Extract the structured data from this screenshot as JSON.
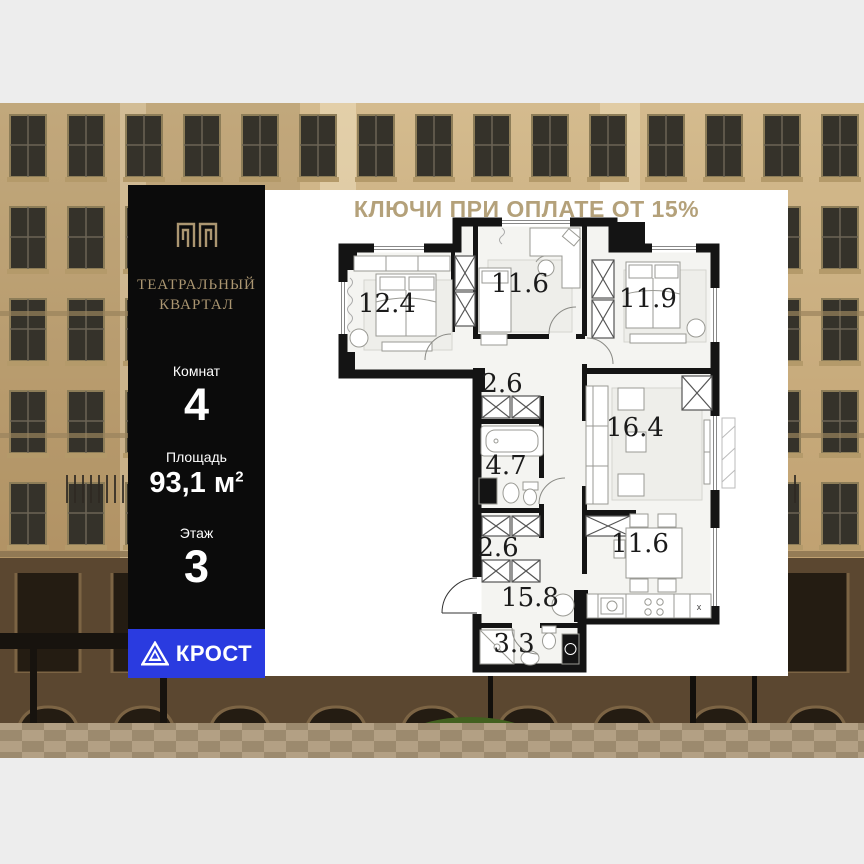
{
  "promo_banner": {
    "text": "КЛЮЧИ ПРИ ОПЛАТЕ ОТ 15%"
  },
  "info_panel": {
    "brand": {
      "line1": "ТЕАТРАЛЬНЫЙ",
      "line2": "КВАРТАЛ"
    },
    "stats": [
      {
        "label": "Комнат",
        "value": "4"
      },
      {
        "label": "Площадь",
        "value": "93,1 м",
        "sup": "2"
      },
      {
        "label": "Этаж",
        "value": "3"
      }
    ],
    "developer": {
      "name": "КРОСТ"
    }
  },
  "floorplan": {
    "room_labels": {
      "bedroom1": "12.4",
      "office": "11.6",
      "bedroom2": "11.9",
      "corridor_top": "2.6",
      "bathroom": "4.7",
      "living": "16.4",
      "corridor_bottom": "2.6",
      "kitchen": "11.6",
      "hall": "15.8",
      "wc": "3.3"
    },
    "counter_mark": "x"
  },
  "colors": {
    "accent_gold": "#b4a17a",
    "accent_blue": "#2a3be0",
    "panel_black": "#0b0b0b",
    "wall_black": "#141414"
  }
}
